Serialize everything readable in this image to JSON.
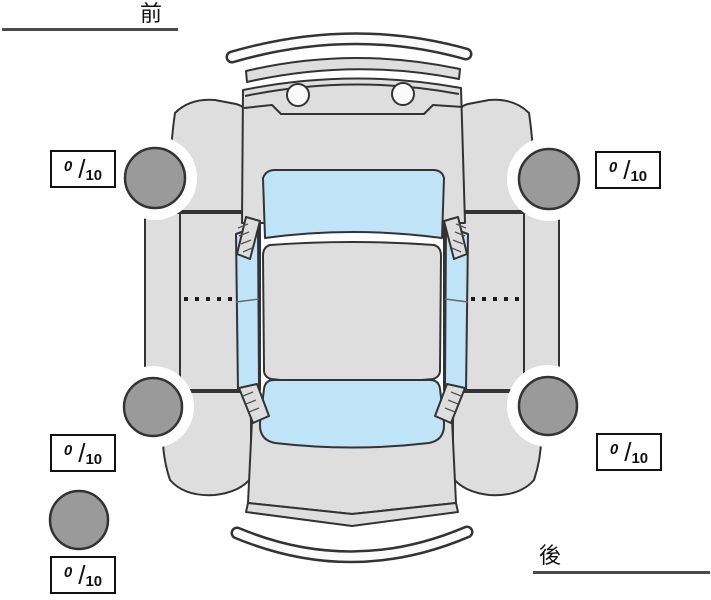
{
  "labels": {
    "front": "前",
    "rear": "後"
  },
  "score_separator": "/",
  "tire_scores": {
    "front_left": {
      "value": "0",
      "max": "10"
    },
    "front_right": {
      "value": "0",
      "max": "10"
    },
    "rear_left": {
      "value": "0",
      "max": "10"
    },
    "rear_right": {
      "value": "0",
      "max": "10"
    },
    "spare": {
      "value": "0",
      "max": "10"
    }
  },
  "colors": {
    "car_body": "#dedede",
    "glass": "#bfe4f7",
    "tire": "#9a9a9a",
    "outline": "#333333",
    "score_box_border": "#111111",
    "label_underline": "#4a4a4a",
    "background": "#ffffff"
  }
}
